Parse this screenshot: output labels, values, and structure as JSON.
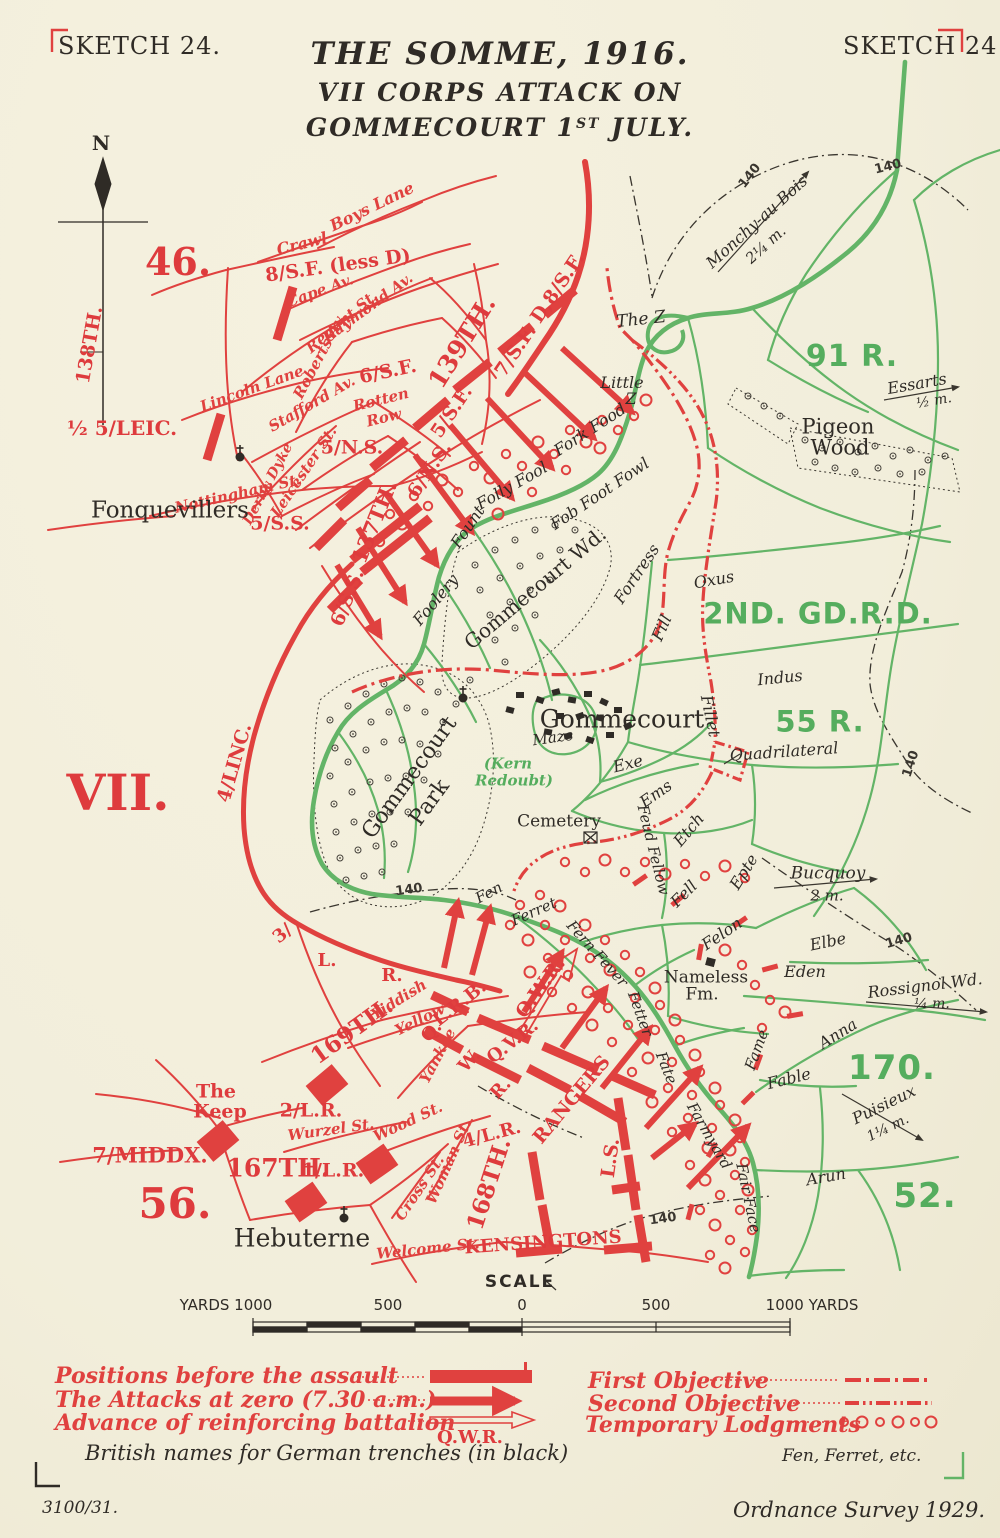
{
  "colors": {
    "red": "#de3b3d",
    "green": "#63b467",
    "black": "#2f2b26",
    "paper": "#f2eedb"
  },
  "header": {
    "sketch_left": "SKETCH 24.",
    "sketch_right": "SKETCH 24",
    "title_line1": "THE SOMME, 1916.",
    "title_line2": "VII CORPS ATTACK ON",
    "title_line3_pre": "GOMMECOURT 1",
    "title_line3_sup": "ST",
    "title_line3_post": " JULY.",
    "north": "N"
  },
  "map": {
    "labels": [
      {
        "t": "46.",
        "x": 178,
        "y": 262,
        "s": 38,
        "c": "ru"
      },
      {
        "t": "138TH.",
        "x": 90,
        "y": 345,
        "r": -80,
        "s": 19,
        "c": "ru"
      },
      {
        "t": "½ 5/LEIC.",
        "x": 122,
        "y": 428,
        "s": 20,
        "c": "ru"
      },
      {
        "t": "5/N.S.",
        "x": 352,
        "y": 448,
        "s": 19,
        "c": "ru"
      },
      {
        "t": "5/S.S.",
        "x": 280,
        "y": 524,
        "s": 19,
        "c": "ru"
      },
      {
        "t": "6/S.S.",
        "x": 348,
        "y": 598,
        "r": -68,
        "s": 19,
        "c": "ru"
      },
      {
        "t": "137TH.",
        "x": 374,
        "y": 522,
        "r": -68,
        "s": 21,
        "c": "ru"
      },
      {
        "t": "6/N.S.",
        "x": 430,
        "y": 470,
        "r": -56,
        "s": 19,
        "c": "ru"
      },
      {
        "t": "5/S.F.",
        "x": 452,
        "y": 412,
        "r": -56,
        "s": 19,
        "c": "ru"
      },
      {
        "t": "139TH.",
        "x": 462,
        "y": 342,
        "r": -58,
        "s": 25,
        "c": "ru"
      },
      {
        "t": "7/S.F.",
        "x": 516,
        "y": 351,
        "r": -56,
        "s": 19,
        "c": "ru"
      },
      {
        "t": "D,8/S.F.",
        "x": 558,
        "y": 288,
        "r": -56,
        "s": 19,
        "c": "ru"
      },
      {
        "t": "6/S.F.",
        "x": 388,
        "y": 372,
        "r": -12,
        "s": 19,
        "c": "ru"
      },
      {
        "t": "8/S.F. (less D)",
        "x": 338,
        "y": 266,
        "r": -8,
        "s": 19,
        "c": "ru"
      },
      {
        "t": "VII.",
        "x": 118,
        "y": 793,
        "s": 50,
        "c": "ru"
      },
      {
        "t": "4/LINC.",
        "x": 235,
        "y": 763,
        "r": -74,
        "s": 19,
        "c": "ru"
      },
      {
        "t": "3/",
        "x": 283,
        "y": 934,
        "r": -40,
        "s": 18,
        "c": "ru"
      },
      {
        "t": "L.",
        "x": 327,
        "y": 961,
        "s": 18,
        "c": "ru"
      },
      {
        "t": "R.",
        "x": 392,
        "y": 976,
        "s": 18,
        "c": "ru"
      },
      {
        "t": "169TH.",
        "x": 352,
        "y": 1031,
        "r": -36,
        "s": 23,
        "c": "ru"
      },
      {
        "t": "L.R.B.",
        "x": 460,
        "y": 1004,
        "r": -38,
        "s": 18,
        "c": "ru"
      },
      {
        "t": "Q.V.R.",
        "x": 513,
        "y": 1042,
        "r": -38,
        "s": 18,
        "c": "ru"
      },
      {
        "t": "Q.",
        "x": 432,
        "y": 1032,
        "r": -48,
        "s": 18,
        "c": "ru"
      },
      {
        "t": "W.",
        "x": 470,
        "y": 1061,
        "r": -48,
        "s": 18,
        "c": "ru"
      },
      {
        "t": "R.",
        "x": 501,
        "y": 1089,
        "r": -48,
        "s": 18,
        "c": "ru"
      },
      {
        "t": "Q.W.R.",
        "x": 541,
        "y": 988,
        "r": -54,
        "s": 19,
        "c": "ru"
      },
      {
        "t": "RANGERS",
        "x": 572,
        "y": 1100,
        "r": -50,
        "s": 19,
        "c": "ru"
      },
      {
        "t": "L.S.",
        "x": 611,
        "y": 1158,
        "r": -82,
        "s": 19,
        "c": "ru"
      },
      {
        "t": "KENSINGTONS",
        "x": 543,
        "y": 1243,
        "r": -4,
        "s": 18,
        "c": "ru"
      },
      {
        "t": "4/L.R.",
        "x": 492,
        "y": 1135,
        "r": -15,
        "s": 18,
        "c": "ru"
      },
      {
        "t": "168TH.",
        "x": 489,
        "y": 1184,
        "r": -72,
        "s": 23,
        "c": "ru"
      },
      {
        "t": "2/L.R.",
        "x": 311,
        "y": 1111,
        "s": 19,
        "c": "ru"
      },
      {
        "t": "1/L.R.",
        "x": 333,
        "y": 1171,
        "s": 19,
        "c": "ru"
      },
      {
        "t": "167TH.",
        "x": 278,
        "y": 1168,
        "s": 25,
        "c": "ru"
      },
      {
        "t": "7/MIDDX.",
        "x": 150,
        "y": 1155,
        "s": 21,
        "c": "ru"
      },
      {
        "t": "56.",
        "x": 175,
        "y": 1204,
        "s": 42,
        "c": "ru"
      },
      {
        "t": "The",
        "x": 216,
        "y": 1092,
        "s": 19,
        "c": "ru"
      },
      {
        "t": "Keep",
        "x": 220,
        "y": 1112,
        "s": 19,
        "c": "ru"
      },
      {
        "t": "Boys Lane",
        "x": 372,
        "y": 207,
        "r": -26,
        "s": 16,
        "c": "ri"
      },
      {
        "t": "Crawl",
        "x": 302,
        "y": 244,
        "r": -14,
        "s": 16,
        "c": "ri"
      },
      {
        "t": "Cape Av.",
        "x": 320,
        "y": 291,
        "r": -20,
        "s": 15,
        "c": "ri"
      },
      {
        "t": "Raymond Av.",
        "x": 368,
        "y": 308,
        "r": -36,
        "s": 15,
        "c": "ri"
      },
      {
        "t": "Regent St.",
        "x": 342,
        "y": 322,
        "r": -40,
        "s": 15,
        "c": "ri"
      },
      {
        "t": "Roberts Av.",
        "x": 320,
        "y": 356,
        "r": -62,
        "s": 15,
        "c": "ri"
      },
      {
        "t": "Rotten",
        "x": 381,
        "y": 400,
        "r": -14,
        "s": 15,
        "c": "ri"
      },
      {
        "t": "Row",
        "x": 384,
        "y": 418,
        "r": -14,
        "s": 15,
        "c": "ri"
      },
      {
        "t": "Stafford Av.",
        "x": 312,
        "y": 404,
        "r": -30,
        "s": 15,
        "c": "ri"
      },
      {
        "t": "Lincoln Lane",
        "x": 252,
        "y": 389,
        "r": -20,
        "s": 15,
        "c": "ri"
      },
      {
        "t": "Leicester St.",
        "x": 304,
        "y": 472,
        "r": -56,
        "s": 15,
        "c": "ri"
      },
      {
        "t": "Derby Dyke",
        "x": 268,
        "y": 484,
        "r": -62,
        "s": 14,
        "c": "ri"
      },
      {
        "t": "Nottingham St.",
        "x": 238,
        "y": 494,
        "r": -13,
        "s": 15,
        "c": "ri"
      },
      {
        "t": "Yiddish",
        "x": 399,
        "y": 1000,
        "r": -32,
        "s": 15,
        "c": "ri"
      },
      {
        "t": "Yellow",
        "x": 420,
        "y": 1020,
        "r": -26,
        "s": 15,
        "c": "ri"
      },
      {
        "t": "Yankee",
        "x": 438,
        "y": 1056,
        "r": -62,
        "s": 15,
        "c": "ri"
      },
      {
        "t": "Wurzel St.",
        "x": 331,
        "y": 1130,
        "r": -8,
        "s": 15,
        "c": "ri"
      },
      {
        "t": "Wood St.",
        "x": 408,
        "y": 1122,
        "r": -25,
        "s": 15,
        "c": "ri"
      },
      {
        "t": "Cross St.",
        "x": 420,
        "y": 1188,
        "r": -56,
        "s": 15,
        "c": "ri"
      },
      {
        "t": "Woman St.",
        "x": 449,
        "y": 1162,
        "r": -66,
        "s": 15,
        "c": "ri"
      },
      {
        "t": "Welcome St.",
        "x": 428,
        "y": 1249,
        "r": -6,
        "s": 15,
        "c": "ri"
      },
      {
        "t": "91 R.",
        "x": 852,
        "y": 357,
        "s": 30,
        "c": "g"
      },
      {
        "t": "2ND. GD.R.D.",
        "x": 818,
        "y": 614,
        "s": 29,
        "c": "g"
      },
      {
        "t": "55 R.",
        "x": 820,
        "y": 722,
        "s": 29,
        "c": "g"
      },
      {
        "t": "170.",
        "x": 892,
        "y": 1068,
        "s": 34,
        "c": "g"
      },
      {
        "t": "52.",
        "x": 925,
        "y": 1196,
        "s": 34,
        "c": "g"
      },
      {
        "t": "(Kern",
        "x": 508,
        "y": 764,
        "s": 15,
        "c": "gi"
      },
      {
        "t": "Redoubt)",
        "x": 514,
        "y": 781,
        "s": 15,
        "c": "gi"
      },
      {
        "t": "Fonquevillers",
        "x": 170,
        "y": 511,
        "s": 23,
        "c": "bp"
      },
      {
        "t": "Hebuterne",
        "x": 302,
        "y": 1238,
        "s": 25,
        "c": "bp"
      },
      {
        "t": "Gommecourt",
        "x": 622,
        "y": 719,
        "s": 25,
        "c": "bp"
      },
      {
        "t": "Pigeon",
        "x": 838,
        "y": 427,
        "s": 21,
        "c": "bp"
      },
      {
        "t": "Wood",
        "x": 840,
        "y": 448,
        "s": 21,
        "c": "bp"
      },
      {
        "t": "Nameless",
        "x": 706,
        "y": 978,
        "s": 17,
        "c": "bp"
      },
      {
        "t": "Fm.",
        "x": 702,
        "y": 995,
        "s": 17,
        "c": "bp"
      },
      {
        "t": "The Z",
        "x": 641,
        "y": 320,
        "r": -6,
        "s": 17,
        "c": "bi"
      },
      {
        "t": "Little",
        "x": 622,
        "y": 383,
        "s": 16,
        "c": "bi"
      },
      {
        "t": "Z",
        "x": 631,
        "y": 399,
        "s": 16,
        "c": "bi"
      },
      {
        "t": "Fork Food",
        "x": 590,
        "y": 430,
        "r": -33,
        "s": 16,
        "c": "bi"
      },
      {
        "t": "Folly Fool",
        "x": 512,
        "y": 486,
        "r": -30,
        "s": 16,
        "c": "bi"
      },
      {
        "t": "Fount",
        "x": 468,
        "y": 527,
        "r": -56,
        "s": 16,
        "c": "bi"
      },
      {
        "t": "Foolery",
        "x": 436,
        "y": 600,
        "r": -50,
        "s": 16,
        "c": "bi"
      },
      {
        "t": "Fob Foot Fowl",
        "x": 600,
        "y": 494,
        "r": -34,
        "s": 16,
        "c": "bi"
      },
      {
        "t": "Fortress",
        "x": 637,
        "y": 574,
        "r": -56,
        "s": 16,
        "c": "bi"
      },
      {
        "t": "Fill",
        "x": 662,
        "y": 628,
        "r": -66,
        "s": 16,
        "c": "bi"
      },
      {
        "t": "Oxus",
        "x": 714,
        "y": 580,
        "r": -10,
        "s": 16,
        "c": "bi"
      },
      {
        "t": "Indus",
        "x": 780,
        "y": 678,
        "r": -6,
        "s": 16,
        "c": "bi"
      },
      {
        "t": "Fillet",
        "x": 710,
        "y": 716,
        "r": 78,
        "s": 16,
        "c": "bi"
      },
      {
        "t": "Exe",
        "x": 628,
        "y": 764,
        "r": -14,
        "s": 16,
        "c": "bi"
      },
      {
        "t": "Ems",
        "x": 656,
        "y": 794,
        "r": -35,
        "s": 16,
        "c": "bi"
      },
      {
        "t": "Etch",
        "x": 689,
        "y": 830,
        "r": -50,
        "s": 16,
        "c": "bi"
      },
      {
        "t": "Feud Fellow",
        "x": 653,
        "y": 850,
        "r": 76,
        "s": 15,
        "c": "bi"
      },
      {
        "t": "Fell",
        "x": 684,
        "y": 894,
        "r": -45,
        "s": 16,
        "c": "bi"
      },
      {
        "t": "Felon",
        "x": 722,
        "y": 934,
        "r": -34,
        "s": 16,
        "c": "bi"
      },
      {
        "t": "Epte",
        "x": 744,
        "y": 872,
        "r": -58,
        "s": 16,
        "c": "bi"
      },
      {
        "t": "Maze",
        "x": 553,
        "y": 738,
        "r": -8,
        "s": 15,
        "c": "bi"
      },
      {
        "t": "Cemetery",
        "x": 559,
        "y": 822,
        "s": 17,
        "c": "bp"
      },
      {
        "t": "Quadrilateral",
        "x": 784,
        "y": 752,
        "r": -4,
        "s": 16,
        "c": "bi"
      },
      {
        "t": "Fen",
        "x": 489,
        "y": 893,
        "r": -28,
        "s": 15,
        "c": "bi"
      },
      {
        "t": "Ferret",
        "x": 534,
        "y": 912,
        "r": -24,
        "s": 15,
        "c": "bi"
      },
      {
        "t": "Fern Fever",
        "x": 597,
        "y": 954,
        "r": 48,
        "s": 15,
        "c": "bi"
      },
      {
        "t": "Fetter",
        "x": 640,
        "y": 1014,
        "r": 70,
        "s": 15,
        "c": "bi"
      },
      {
        "t": "Fate",
        "x": 666,
        "y": 1068,
        "r": 68,
        "s": 15,
        "c": "bi"
      },
      {
        "t": "Farmyard",
        "x": 709,
        "y": 1136,
        "r": 60,
        "s": 15,
        "c": "bi"
      },
      {
        "t": "Fair Face",
        "x": 748,
        "y": 1198,
        "r": 78,
        "s": 15,
        "c": "bi"
      },
      {
        "t": "Fame",
        "x": 757,
        "y": 1050,
        "r": -70,
        "s": 15,
        "c": "bi"
      },
      {
        "t": "Fable",
        "x": 789,
        "y": 1079,
        "r": -14,
        "s": 16,
        "c": "bi"
      },
      {
        "t": "Anna",
        "x": 838,
        "y": 1034,
        "r": -32,
        "s": 16,
        "c": "bi"
      },
      {
        "t": "Elbe",
        "x": 828,
        "y": 942,
        "r": -12,
        "s": 16,
        "c": "bi"
      },
      {
        "t": "Eden",
        "x": 805,
        "y": 972,
        "s": 16,
        "c": "bi"
      },
      {
        "t": "Arun",
        "x": 826,
        "y": 1177,
        "r": -10,
        "s": 16,
        "c": "bi"
      },
      {
        "t": "Gommecourt Wd.",
        "x": 535,
        "y": 588,
        "r": -40,
        "s": 20,
        "c": "bp"
      },
      {
        "t": "Gommecourt",
        "x": 410,
        "y": 778,
        "r": -54,
        "s": 22,
        "c": "bp"
      },
      {
        "t": "Park",
        "x": 430,
        "y": 803,
        "r": -54,
        "s": 22,
        "c": "bp"
      },
      {
        "t": "Monchy-au Bois",
        "x": 757,
        "y": 222,
        "r": -42,
        "s": 16,
        "c": "bi"
      },
      {
        "t": "2¼ m.",
        "x": 766,
        "y": 245,
        "r": -42,
        "s": 15,
        "c": "bi"
      },
      {
        "t": "Essarts",
        "x": 917,
        "y": 384,
        "r": -10,
        "s": 16,
        "c": "bi"
      },
      {
        "t": "½ m.",
        "x": 934,
        "y": 401,
        "r": -10,
        "s": 14,
        "c": "bi"
      },
      {
        "t": "Bucquoy",
        "x": 828,
        "y": 874,
        "s": 17,
        "c": "bi"
      },
      {
        "t": "2 m.",
        "x": 827,
        "y": 896,
        "s": 15,
        "c": "bi"
      },
      {
        "t": "Rossignol Wd.",
        "x": 925,
        "y": 986,
        "r": -7,
        "s": 16,
        "c": "bi"
      },
      {
        "t": "¼ m.",
        "x": 932,
        "y": 1004,
        "s": 14,
        "c": "bi"
      },
      {
        "t": "Puisieux",
        "x": 884,
        "y": 1105,
        "r": -26,
        "s": 16,
        "c": "bi"
      },
      {
        "t": "1¼ m.",
        "x": 888,
        "y": 1128,
        "r": -26,
        "s": 14,
        "c": "bi"
      },
      {
        "t": "140",
        "x": 750,
        "y": 176,
        "r": -52,
        "s": 13,
        "c": "bc"
      },
      {
        "t": "140",
        "x": 888,
        "y": 167,
        "r": -14,
        "s": 13,
        "c": "bc"
      },
      {
        "t": "140",
        "x": 911,
        "y": 764,
        "r": -72,
        "s": 13,
        "c": "bc"
      },
      {
        "t": "140",
        "x": 409,
        "y": 890,
        "r": -8,
        "s": 13,
        "c": "bc"
      },
      {
        "t": "140",
        "x": 899,
        "y": 941,
        "r": -16,
        "s": 13,
        "c": "bc"
      },
      {
        "t": "140",
        "x": 663,
        "y": 1219,
        "r": -8,
        "s": 13,
        "c": "bc"
      }
    ]
  },
  "scale": {
    "title": "SCALE",
    "left_label": "YARDS 1000",
    "l500": "500",
    "zero": "0",
    "r500": "500",
    "right_label": "1000 YARDS"
  },
  "legend": {
    "left_rows": [
      {
        "label": "Positions before the assault"
      },
      {
        "label": "The Attacks at zero (7.30 a.m.)"
      },
      {
        "label": "Advance of reinforcing battalion"
      }
    ],
    "qwr": "Q.W.R.",
    "left_note": "British names for German trenches (in black)",
    "right_rows": [
      {
        "label": "First Objective"
      },
      {
        "label": "Second Objective"
      },
      {
        "label": "Temporary Lodgments"
      }
    ],
    "right_note": "Fen, Ferret, etc."
  },
  "footer": {
    "ref": "3100/31.",
    "source": "Ordnance Survey 1929."
  }
}
